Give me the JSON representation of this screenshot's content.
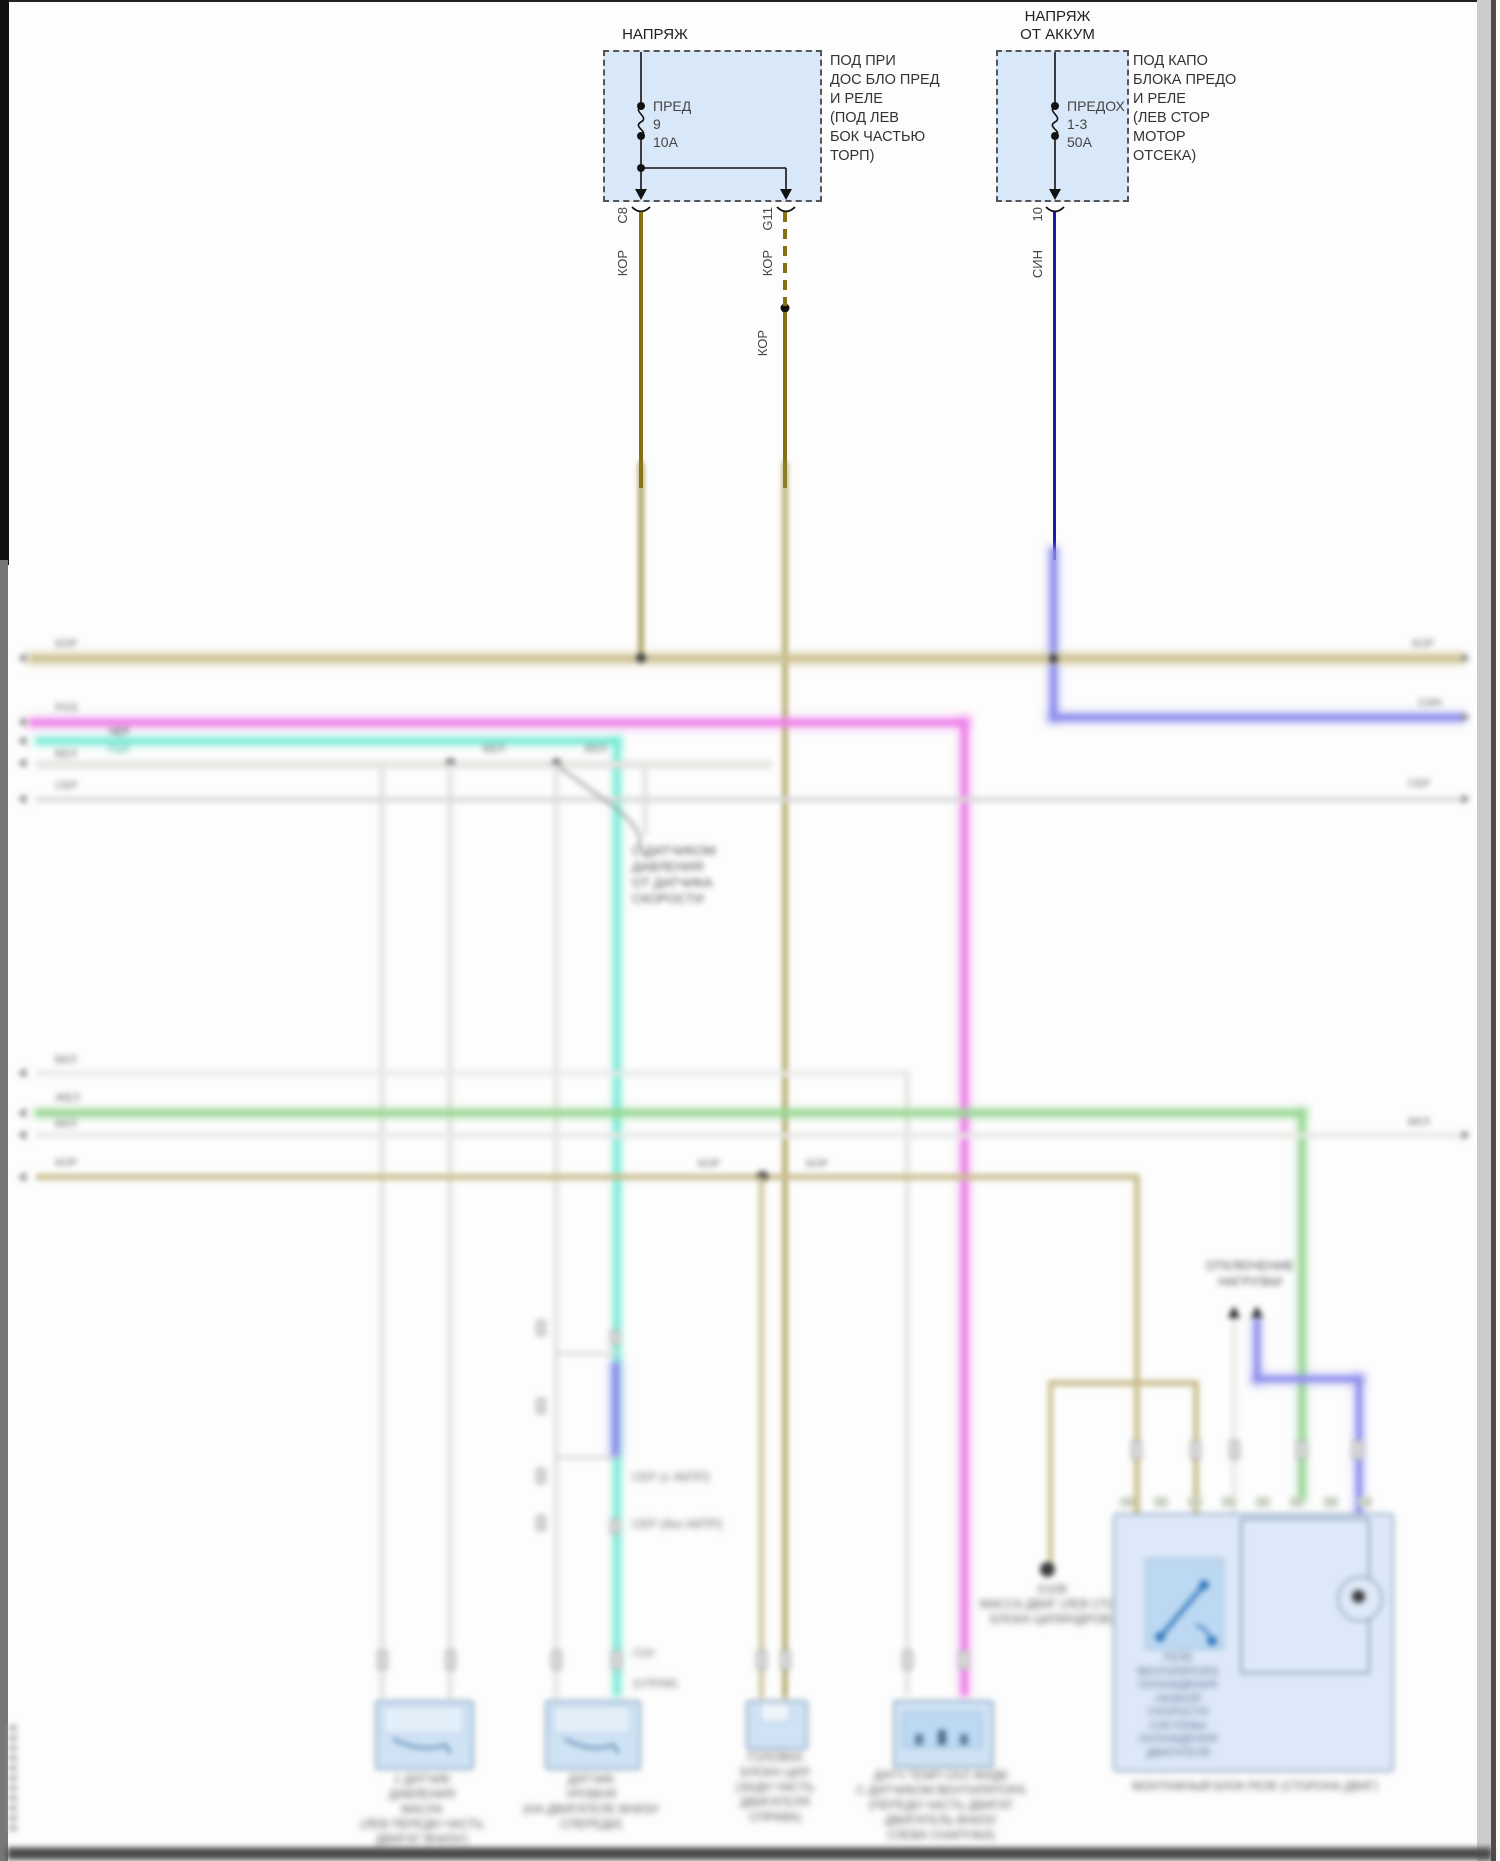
{
  "colors": {
    "fuse_fill": "#d9e8f8",
    "olive_wire": "#857111",
    "tan_bus": "#cdc295",
    "blue_wire": "#1c1ca8",
    "violet_bus": "#8f8fee",
    "pink_bus": "#ef83ea",
    "cyan_bus": "#79ead6",
    "green_bus": "#98d793",
    "connector_fill": "#cfe3f5",
    "relay_fill": "#dde9f8"
  },
  "fuse_box_left": {
    "title": "НАПРЯЖ",
    "fuse_name": "ПРЕД",
    "fuse_id": "9",
    "fuse_rating": "10А",
    "location": [
      "ПОД ПРИ",
      "ДОС БЛО ПРЕД",
      "И РЕЛЕ",
      "(ПОД ЛЕВ",
      "БОК ЧАСТЬЮ",
      "ТОРП)"
    ],
    "conn_a": "C8",
    "conn_b": "G11",
    "wire_a_color": "КОР",
    "wire_b_color": "КОР",
    "wire_b_color2": "КОР"
  },
  "fuse_box_right": {
    "title": [
      "НАПРЯЖ",
      "ОТ АККУМ"
    ],
    "fuse_name": "ПРЕДОХ",
    "fuse_id": "1-3",
    "fuse_rating": "50А",
    "location": [
      "ПОД КАПО",
      "БЛОКА ПРЕДО",
      "И РЕЛЕ",
      "(ЛЕВ СТОР",
      "МОТОР",
      "ОТСЕКА)"
    ],
    "conn": "10",
    "wire_color": "СИН"
  },
  "bus": {
    "tan_left": "КОР",
    "tan_right": "КОР",
    "blue_right": "СИН",
    "pink_left": "РОЗ",
    "pink_left2": "ЧЕР",
    "cyan_left": "ГОЛ",
    "white1_left": "БЕЛ",
    "white1_mid1": "БЕЛ",
    "white1_mid2": "БЕЛ",
    "gray_left": "СЕР",
    "gray_right": "СЕР",
    "white2_left": "БЕЛ",
    "green_left": "ЖЕЛ",
    "white3_left": "БЕЛ",
    "white3_right": "БЕЛ",
    "tan2_left": "КОР",
    "tan2_mid_left": "КОР",
    "tan2_mid_right": "КОР",
    "conn2_lbl1": "ГОЛ",
    "conn2_lbl2": "(СПРАВ)"
  },
  "splice_note": {
    "lines": [
      "С ДАТЧИКОМ",
      "ДАВЛЕНИЯ",
      "ОТ ДАТЧИКА",
      "СКОРОСТИ"
    ]
  },
  "mid": {
    "ann1": "СЕР (с АКПП)",
    "ann2": "СЕР (без АКПП)"
  },
  "disconnect": {
    "lines": [
      "ОТКЛЮЧЕНИЕ",
      "НАГРУЗКИ"
    ]
  },
  "ground": {
    "lines": [
      "G108",
      "МАССА ДВИГ (ЛЕВ СТОР",
      "БЛОКА ЦИЛИНДРОВ)"
    ]
  },
  "relay_box": {
    "inner_lines": [
      "РЕЛЕ",
      "ВЕНТИЛЯТОРА",
      "ОХЛАЖДЕНИЯ",
      "НИЗКОЙ",
      "СКОРОСТИ",
      "СИСТЕМЫ",
      "ОХЛАЖДЕНИЯ",
      "ДВИГАТЕЛЯ"
    ],
    "caption": "МОНТАЖНЫЙ БЛОК РЕЛЕ (СТОРОНА ДВИГ)"
  },
  "connectors": {
    "c1": {
      "lines": [
        "1 ДАТЧИК",
        "ДАВЛЕНИЯ",
        "МАСЛА",
        "(ЛЕВ ПЕРЕДН ЧАСТЬ",
        "ДВИГАТ ВНИЗУ)"
      ]
    },
    "c2": {
      "lines": [
        "ДАТЧИК",
        "УРОВНЯ",
        "(НА ДВИГАТЕЛЕ ВНИЗУ",
        "СПЕРЕДИ)"
      ]
    },
    "c3": {
      "lines": [
        "ГОЛОВКА",
        "БЛОКА ЦИЛ",
        "(ЗАДН ЧАСТЬ",
        "ДВИГАТЕЛЯ",
        "СПРАВА)"
      ]
    },
    "c4": {
      "lines": [
        "ДАТЧ ТЕМП ОХЛ ЖИДК",
        "С ДАТЧИКОМ ВЕНТИЛЯТОРА",
        "(ПЕРЕДН ЧАСТЬ ДВИГАТ",
        "ДВИГАТЕЛЬ ВНИЗУ",
        "СЛЕВА СНАРУЖИ)"
      ]
    }
  }
}
